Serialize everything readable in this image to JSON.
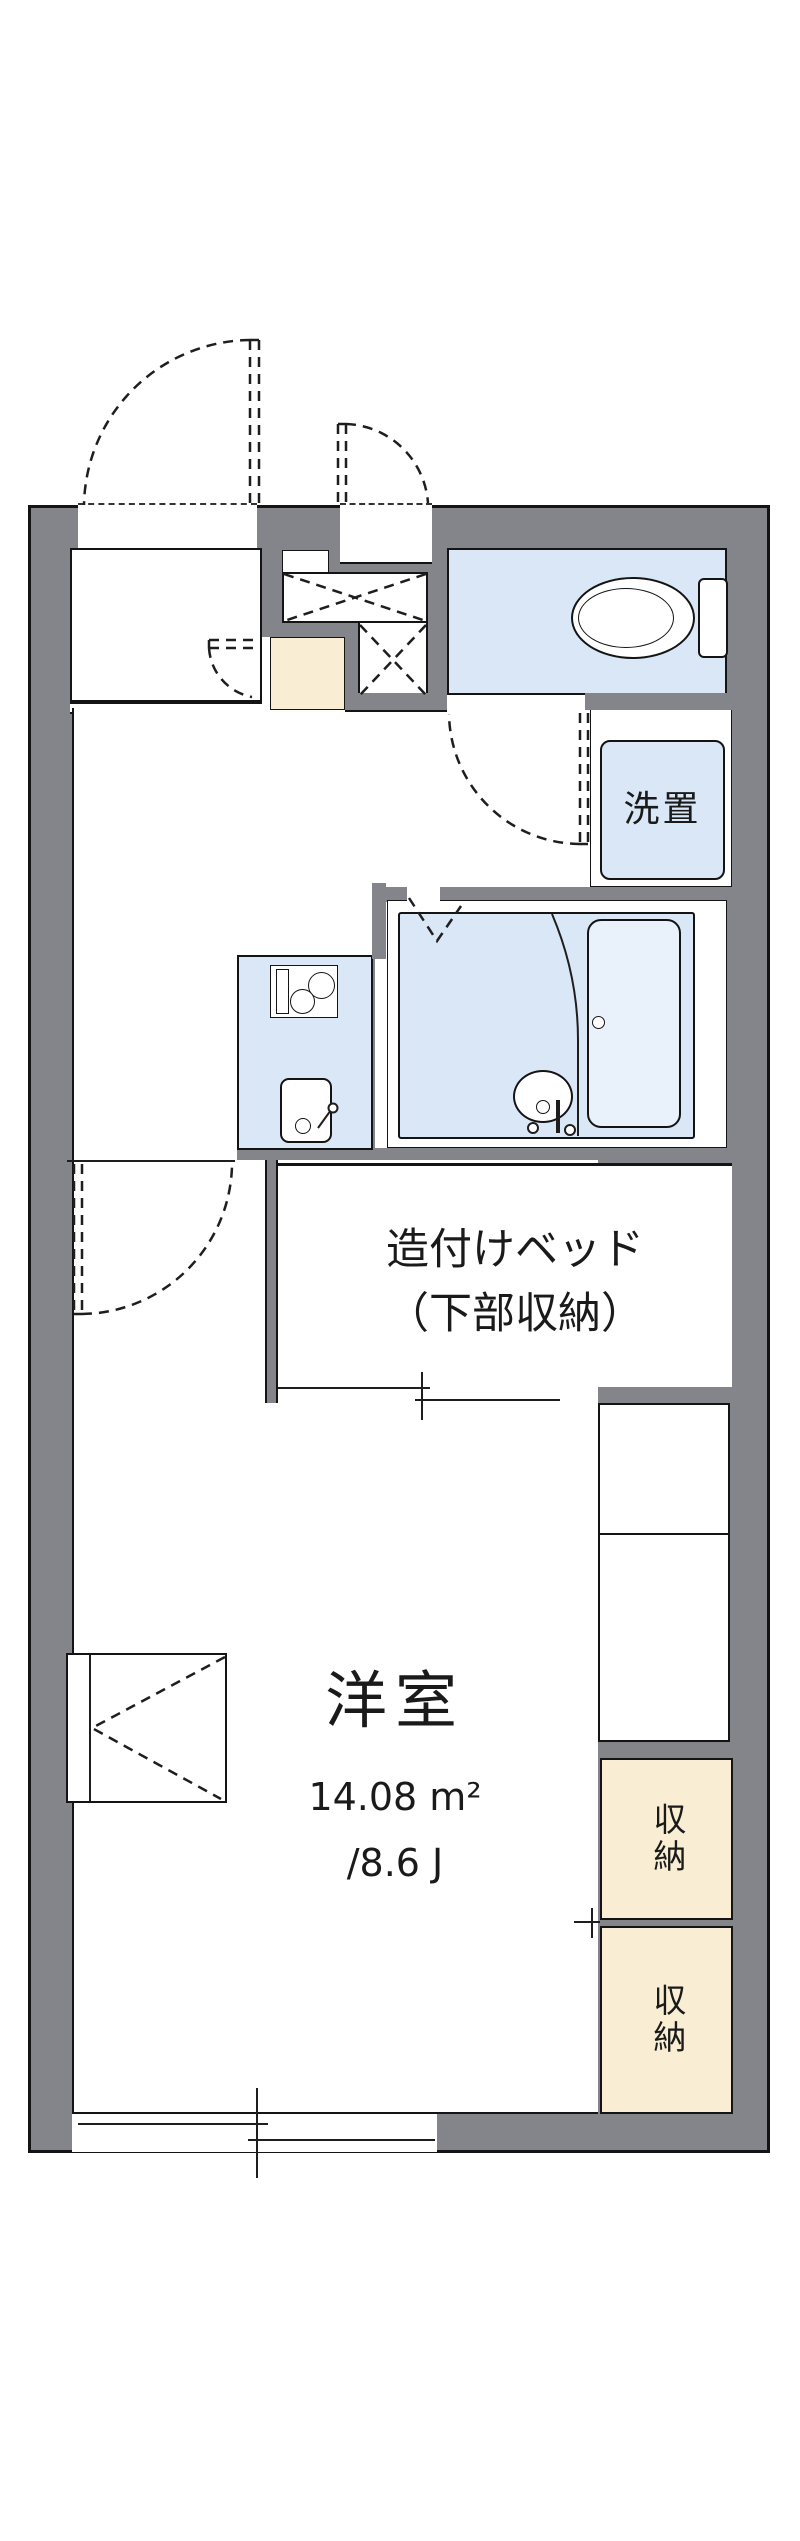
{
  "plan": {
    "room_label": "洋室",
    "room_area_sqm": "14.08 m²",
    "room_area_tatami": "/8.6 J",
    "bed_label_line1": "造付けベッド",
    "bed_label_line2": "（下部収納）",
    "washer_label": "洗置",
    "storage_upper_label": "収納",
    "storage_lower_label": "収納",
    "colors": {
      "wall": "#84848B",
      "wet_area": "#D9E7F7",
      "storage": "#F9EDD3",
      "bathtub": "#E9F1FB",
      "line": "#141414"
    }
  }
}
